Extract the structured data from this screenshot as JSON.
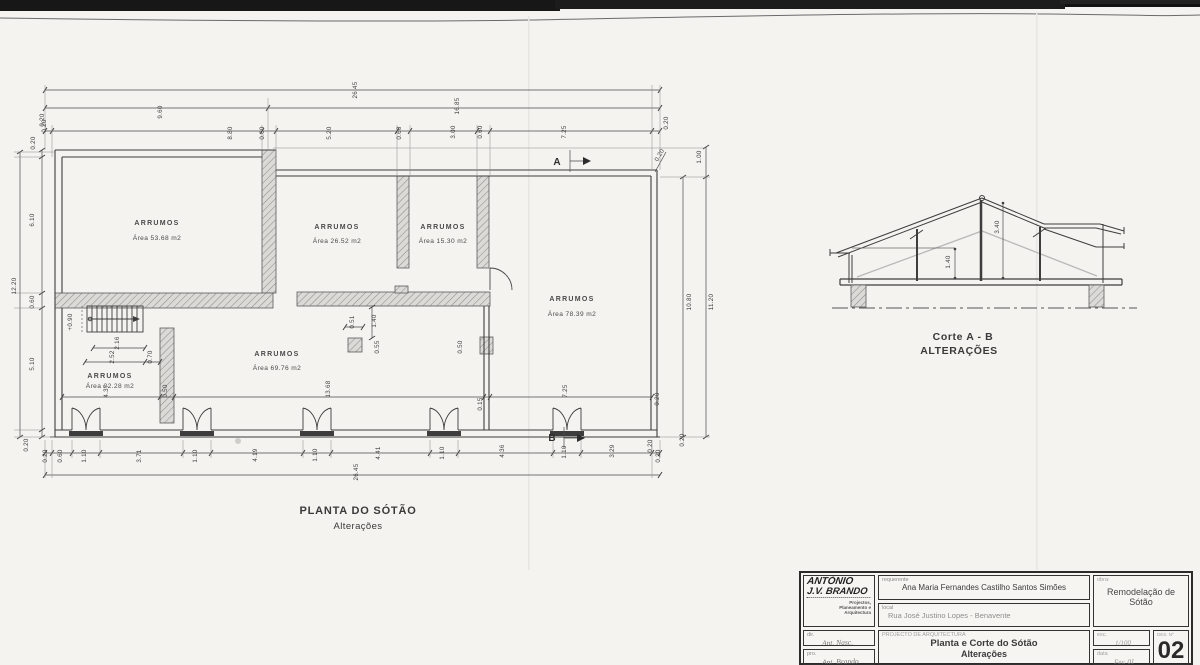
{
  "plan": {
    "title": "PLANTA DO SÓTÃO",
    "subtitle": "Alterações",
    "rooms": [
      {
        "name": "ARRUMOS",
        "area": "Área  53.68 m2",
        "x": 157,
        "y": 225,
        "y2": 240
      },
      {
        "name": "ARRUMOS",
        "area": "Área  26.52 m2",
        "x": 337,
        "y": 229,
        "y2": 243
      },
      {
        "name": "ARRUMOS",
        "area": "Área  15.30 m2",
        "x": 443,
        "y": 229,
        "y2": 243
      },
      {
        "name": "ARRUMOS",
        "area": "Área  78.39 m2",
        "x": 572,
        "y": 301,
        "y2": 316
      },
      {
        "name": "ARRUMOS",
        "area": "Área  69.76 m2",
        "x": 277,
        "y": 356,
        "y2": 370
      },
      {
        "name": "ARRUMOS",
        "area": "Área  22.28 m2",
        "x": 110,
        "y": 378,
        "y2": 388
      }
    ],
    "section_marks": [
      {
        "t": "A",
        "x": 557,
        "y": 165
      },
      {
        "t": "B",
        "x": 552,
        "y": 441
      }
    ],
    "dim_labels": [
      {
        "t": "26.45",
        "x": 357,
        "y": 90,
        "r": -90
      },
      {
        "t": "9.60",
        "x": 162,
        "y": 112,
        "r": -90
      },
      {
        "t": "16.85",
        "x": 459,
        "y": 106,
        "r": -90
      },
      {
        "t": "0.20",
        "x": 46,
        "y": 126,
        "r": -90
      },
      {
        "t": "8.80",
        "x": 232,
        "y": 133,
        "r": -90
      },
      {
        "t": "0.60",
        "x": 264,
        "y": 133,
        "r": -90
      },
      {
        "t": "5.20",
        "x": 331,
        "y": 133,
        "r": -90
      },
      {
        "t": "0.60",
        "x": 401,
        "y": 133,
        "r": -90
      },
      {
        "t": "3.00",
        "x": 455,
        "y": 132,
        "r": -90
      },
      {
        "t": "0.60",
        "x": 482,
        "y": 132,
        "r": -90
      },
      {
        "t": "7.25",
        "x": 566,
        "y": 132,
        "r": -90
      },
      {
        "t": "0.20",
        "x": 668,
        "y": 123,
        "r": -90
      },
      {
        "t": "0.20",
        "x": 661,
        "y": 156,
        "r": -60
      },
      {
        "t": "1.00",
        "x": 701,
        "y": 157,
        "r": -90
      },
      {
        "t": "12.20",
        "x": 16,
        "y": 286,
        "r": -90
      },
      {
        "t": "0.20",
        "x": 44,
        "y": 120,
        "r": -90
      },
      {
        "t": "0.20",
        "x": 35,
        "y": 143,
        "r": -90
      },
      {
        "t": "6.10",
        "x": 34,
        "y": 220,
        "r": -90
      },
      {
        "t": "0.60",
        "x": 34,
        "y": 302,
        "r": -90
      },
      {
        "t": "5.10",
        "x": 34,
        "y": 364,
        "r": -90
      },
      {
        "t": "0.20",
        "x": 28,
        "y": 445,
        "r": -90
      },
      {
        "t": "+0.90",
        "x": 72,
        "y": 322,
        "r": -90
      },
      {
        "t": "2.16",
        "x": 119,
        "y": 343,
        "r": -90
      },
      {
        "t": "2.52",
        "x": 114,
        "y": 357,
        "r": -90
      },
      {
        "t": "0.70",
        "x": 152,
        "y": 357,
        "r": -90
      },
      {
        "t": "4.37",
        "x": 108,
        "y": 391,
        "r": -90
      },
      {
        "t": "0.50",
        "x": 167,
        "y": 391,
        "r": -90
      },
      {
        "t": "13.68",
        "x": 330,
        "y": 389,
        "r": -90
      },
      {
        "t": "0.15",
        "x": 482,
        "y": 404,
        "r": -90
      },
      {
        "t": "7.25",
        "x": 567,
        "y": 391,
        "r": -90
      },
      {
        "t": "0.20",
        "x": 659,
        "y": 399,
        "r": -90
      },
      {
        "t": "0.51",
        "x": 354,
        "y": 322,
        "r": -90
      },
      {
        "t": "1.40",
        "x": 376,
        "y": 321,
        "r": -90
      },
      {
        "t": "0.55",
        "x": 379,
        "y": 347,
        "r": -90
      },
      {
        "t": "0.50",
        "x": 462,
        "y": 347,
        "r": -90
      },
      {
        "t": "10.80",
        "x": 691,
        "y": 302,
        "r": -90
      },
      {
        "t": "11.20",
        "x": 713,
        "y": 302,
        "r": -90
      },
      {
        "t": "0.20",
        "x": 652,
        "y": 446,
        "r": -90
      },
      {
        "t": "0.20",
        "x": 684,
        "y": 440,
        "r": -90
      },
      {
        "t": "0.20",
        "x": 47,
        "y": 456,
        "r": -90
      },
      {
        "t": "0.60",
        "x": 62,
        "y": 456,
        "r": -90
      },
      {
        "t": "1.10",
        "x": 86,
        "y": 456,
        "r": -90
      },
      {
        "t": "3.71",
        "x": 141,
        "y": 456,
        "r": -90
      },
      {
        "t": "1.10",
        "x": 197,
        "y": 456,
        "r": -90
      },
      {
        "t": "4.19",
        "x": 257,
        "y": 455,
        "r": -90
      },
      {
        "t": "1.10",
        "x": 317,
        "y": 455,
        "r": -90
      },
      {
        "t": "4.41",
        "x": 380,
        "y": 453,
        "r": -90
      },
      {
        "t": "1.10",
        "x": 444,
        "y": 453,
        "r": -90
      },
      {
        "t": "4.36",
        "x": 504,
        "y": 451,
        "r": -90
      },
      {
        "t": "1.10",
        "x": 566,
        "y": 452,
        "r": -90
      },
      {
        "t": "3.29",
        "x": 614,
        "y": 451,
        "r": -90
      },
      {
        "t": "0.20",
        "x": 660,
        "y": 456,
        "r": -90
      },
      {
        "t": "26.45",
        "x": 358,
        "y": 472,
        "r": -90
      }
    ]
  },
  "section": {
    "caption1": "Corte  A - B",
    "caption2": "ALTERAÇÕES",
    "dim_labels": [
      {
        "t": "3.40",
        "x": 999,
        "y": 227,
        "r": -90
      },
      {
        "t": "1.40",
        "x": 950,
        "y": 262,
        "r": -90
      }
    ]
  },
  "titleblock": {
    "logo_line1": "ANTÓNIO",
    "logo_line2": "J.V. BRANDO",
    "logo_small1": "Projectos,",
    "logo_small2": "Planeamento e",
    "logo_small3": "Arquitectura",
    "requerente_label": "requerente",
    "requerente_value": "Ana Maria Fernandes Castilho Santos Simões",
    "local_label": "local",
    "local_value": "Rua José Justino Lopes  -  Benavente",
    "obra_label": "obra:",
    "obra_line1": "Remodelação de",
    "obra_line2": "Sótão",
    "dir_label": "dir.",
    "dir_value": "Ant. Nasc.",
    "pro_label": "pro.",
    "pro_value": "Ant. Brando",
    "projecto_label": "PROJECTO DE ARQUITECTURA",
    "projecto_line1": "Planta e Corte do Sótão",
    "projecto_line2": "Alterações",
    "esc_label": "esc.",
    "esc_value": "1/100",
    "data_label": "data",
    "data_value": "Fev. 01",
    "des_label": "DES. Nº",
    "des_value": "02"
  }
}
